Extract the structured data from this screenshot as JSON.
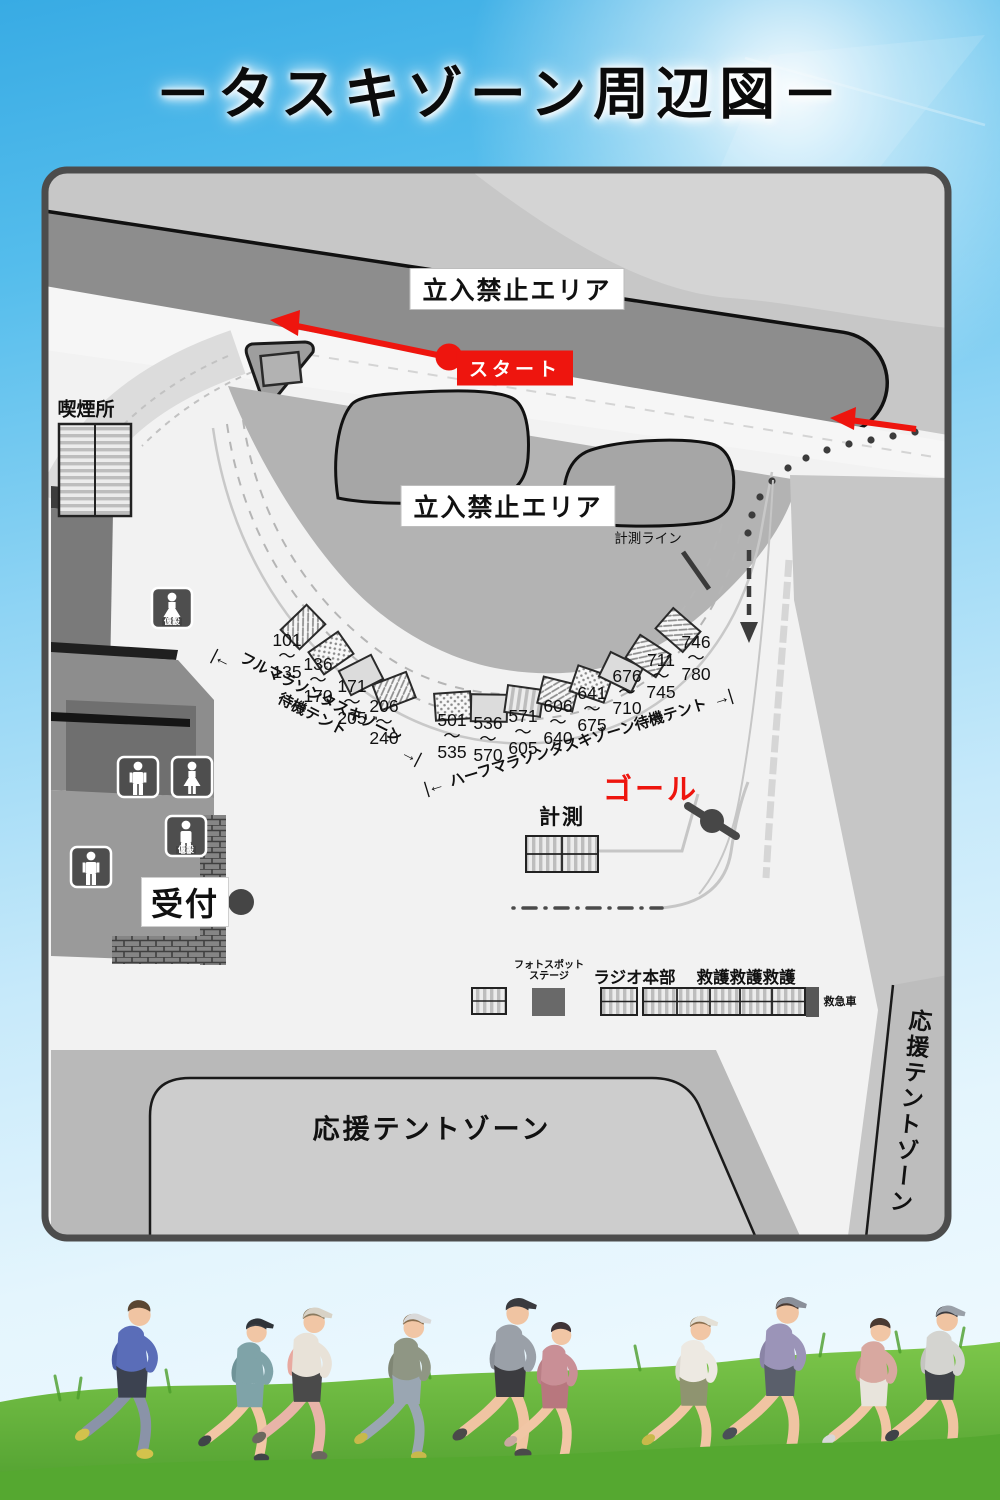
{
  "title": "－タスキゾーン周辺図－",
  "colors": {
    "accent_red": "#ee150e",
    "sky_blue": "#4db4e7",
    "map_gray": "#b3b3b3",
    "grass_green": "#5fae35"
  },
  "map": {
    "restricted_top": "立入禁止エリア",
    "restricted_center": "立入禁止エリア",
    "start": "スタート",
    "goal": "ゴール",
    "timing_line": "計測ライン",
    "timing": "計測",
    "smoking": "喫煙所",
    "reception": "受付",
    "temp_toilet": "仮設",
    "tilde": "～",
    "arrow_left": "|←",
    "arrow_right": "→|",
    "full_zone_line1": "フルマラソンタスキゾーン",
    "full_zone_line2": "待機テント",
    "half_zone": "ハーフマラソンタスキゾーン待機テント",
    "support_zone_bottom": "応援テントゾーン",
    "support_zone_right": "応援テントゾーン",
    "photo_line1": "フォトスポット",
    "photo_line2": "ステージ",
    "radio": "ラジオ",
    "hq": "本部",
    "aid1": "救護",
    "aid2": "救護",
    "aid3": "救護",
    "ambulance": "救急車",
    "full_tents": [
      {
        "s": "101",
        "e": "135"
      },
      {
        "s": "136",
        "e": "170"
      },
      {
        "s": "171",
        "e": "205"
      },
      {
        "s": "206",
        "e": "240"
      }
    ],
    "half_tents": [
      {
        "s": "501",
        "e": "535"
      },
      {
        "s": "536",
        "e": "570"
      },
      {
        "s": "571",
        "e": "605"
      },
      {
        "s": "606",
        "e": "640"
      },
      {
        "s": "641",
        "e": "675"
      },
      {
        "s": "676",
        "e": "710"
      },
      {
        "s": "711",
        "e": "745"
      },
      {
        "s": "746",
        "e": "780"
      }
    ]
  }
}
